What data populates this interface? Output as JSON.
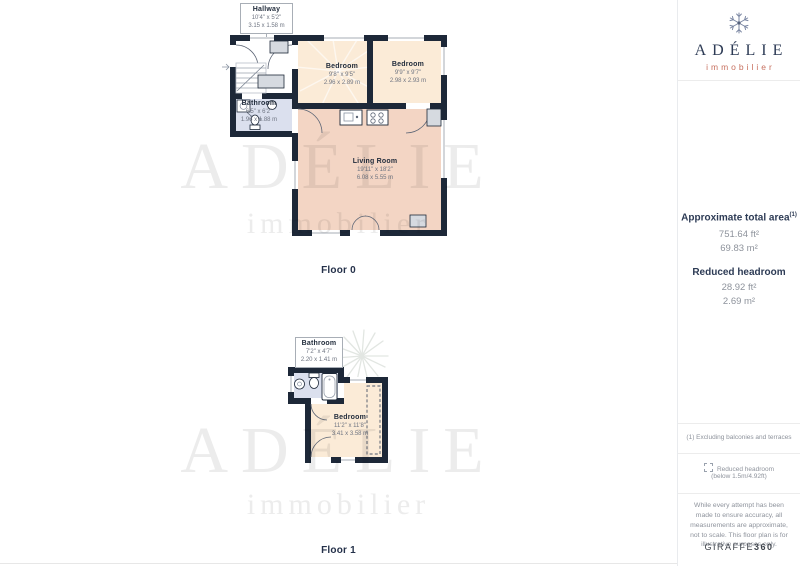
{
  "brand": {
    "name": "ADÉLIE",
    "tagline": "immobilier"
  },
  "watermark": {
    "name": "ADÉLIE",
    "tagline": "immobilier"
  },
  "floors": [
    {
      "label": "Floor 0",
      "callout": {
        "name": "Hallway",
        "imperial": "10'4\" x 5'2\"",
        "metric": "3.15 x 1.58 m"
      },
      "rooms": [
        {
          "name": "Bathroom",
          "imperial": "6'5\" x 6'2\"",
          "metric": "1.96 x 1.88 m"
        },
        {
          "name": "Bedroom",
          "imperial": "9'8\" x 9'5\"",
          "metric": "2.96 x 2.89 m"
        },
        {
          "name": "Bedroom",
          "imperial": "9'9\" x 9'7\"",
          "metric": "2.98 x 2.93 m"
        },
        {
          "name": "Living Room",
          "imperial": "19'11\" x 18'2\"",
          "metric": "6.08 x 5.55 m"
        }
      ]
    },
    {
      "label": "Floor 1",
      "callout": {
        "name": "Bathroom",
        "imperial": "7'2\" x 4'7\"",
        "metric": "2.20 x 1.41 m"
      },
      "rooms": [
        {
          "name": "Bedroom",
          "imperial": "11'2\" x 11'8\"",
          "metric": "3.41 x 3.58 m"
        }
      ]
    }
  ],
  "sidebar": {
    "total_area_title": "Approximate total area",
    "total_area_note_marker": "(1)",
    "total_area_ft": "751.64 ft²",
    "total_area_m": "69.83 m²",
    "reduced_headroom_title": "Reduced headroom",
    "reduced_headroom_ft": "28.92 ft²",
    "reduced_headroom_m": "2.69 m²",
    "footnote": "(1) Excluding balconies and terraces",
    "legend_label": "Reduced headroom",
    "legend_detail": "(below 1.5m/4.92ft)",
    "disclaimer": "While every attempt has been made to ensure accuracy, all measurements are approximate, not to scale. This floor plan is for illustrative purposes only.",
    "provider_name": "GIRAFFE",
    "provider_suffix": "360"
  },
  "colors": {
    "wall": "#1d2838",
    "bedroom_floor": "#fbebd7",
    "living_floor": "#f3d5c4",
    "bathroom_floor": "#dbe0ee",
    "brand_navy": "#2d3b55",
    "brand_coral": "#c7705f",
    "watermark": "#ececec"
  }
}
